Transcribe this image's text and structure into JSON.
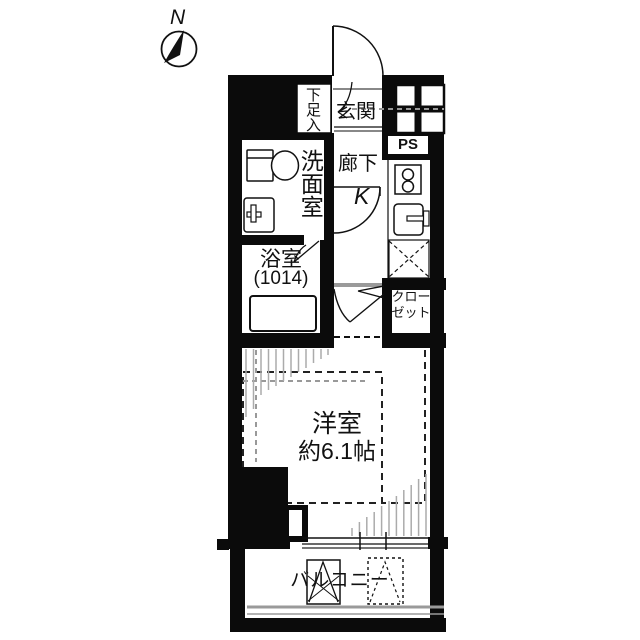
{
  "compass": {
    "north_label": "N"
  },
  "rooms": {
    "shoe_cabinet": "下足入",
    "entrance": "玄関",
    "pipe_space": "PS",
    "hallway": "廊下",
    "kitchen": "K",
    "washroom": "洗面室",
    "bathroom": "浴室",
    "bathroom_size": "(1014)",
    "closet_line1": "クロー",
    "closet_line2": "ゼット",
    "main_room_line1": "洋室",
    "main_room_line2": "約6.1帖",
    "balcony": "バルコニー"
  },
  "colors": {
    "wall": "#0b0b0b",
    "hatch_gray": "#ababab",
    "guide_gray": "#999999",
    "railing_gray": "#9a9a9a"
  }
}
